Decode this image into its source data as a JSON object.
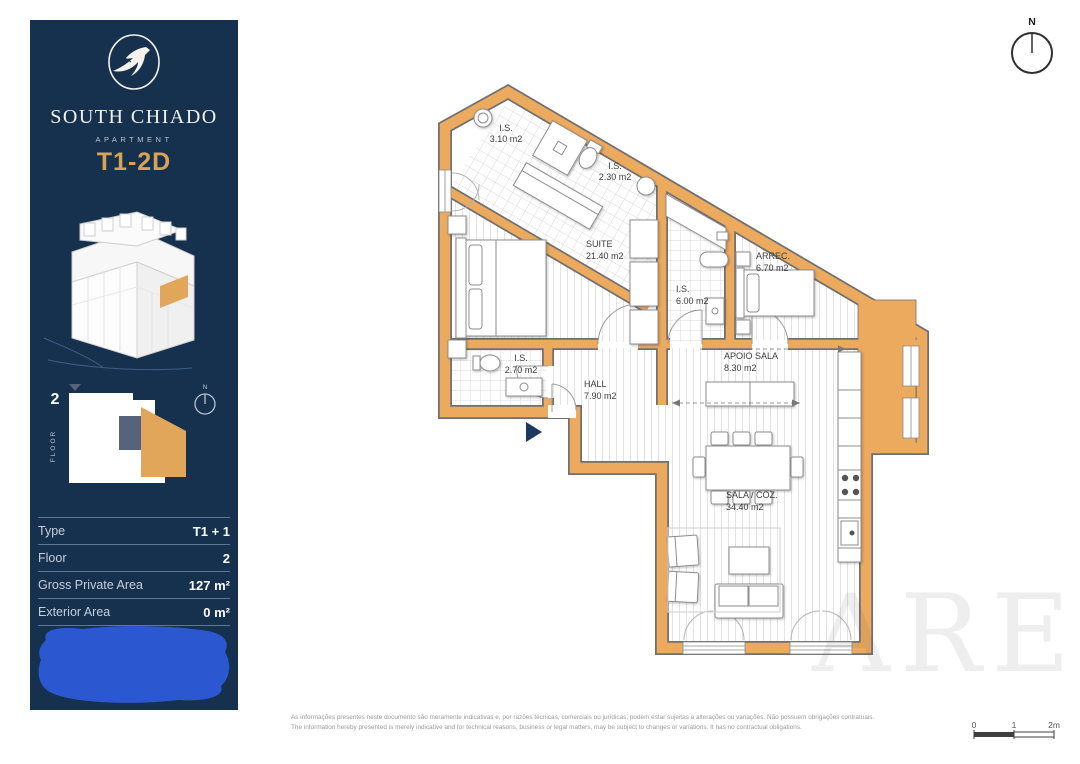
{
  "sidebar": {
    "brand": "SOUTH CHIADO",
    "subtitle": "APARTMENT",
    "unit_label": "T1-2D",
    "floor_key": {
      "floor_number": "2",
      "floor_label": "FLOOR",
      "north_label": "N"
    },
    "spec_table": {
      "rows": [
        {
          "label": "Type",
          "value": "T1 + 1"
        },
        {
          "label": "Floor",
          "value": "2"
        },
        {
          "label": "Gross Private Area",
          "value": "127 m²"
        },
        {
          "label": "Exterior Area",
          "value": "0 m²"
        }
      ]
    }
  },
  "plan": {
    "north_label": "N",
    "rooms": [
      {
        "name": "I.S.",
        "area": "3.10 m2"
      },
      {
        "name": "I.S.",
        "area": "2.30 m2"
      },
      {
        "name": "SUITE",
        "area": "21.40 m2"
      },
      {
        "name": "I.S.",
        "area": "6.00 m2"
      },
      {
        "name": "ARREC.",
        "area": "6.70 m2"
      },
      {
        "name": "I.S.",
        "area": "2.70 m2"
      },
      {
        "name": "HALL",
        "area": "7.90 m2"
      },
      {
        "name": "APOIO SALA",
        "area": "8.30 m2"
      },
      {
        "name": "SALA / COZ.",
        "area": "34.40 m2"
      }
    ]
  },
  "footer": {
    "disclaimer_pt": "As informações presentes neste documento são meramente indicativas e, por razões técnicas, comerciais ou jurídicas, podem estar sujeitas a alterações ou variações. Não possuem obrigações contratuais.",
    "disclaimer_en": "The information hereby presented is merely indicative and for technical reasons, business or legal matters, may be subject to changes or variations. It has no contractual obligations.",
    "scale_labels": {
      "zero": "0",
      "one": "1",
      "two": "2m"
    }
  },
  "watermark": "ARE",
  "colors": {
    "sidebar_navy": "#16314e",
    "accent_gold": "#d8a355",
    "wall_orange": "#ecaa5e",
    "redaction_blue": "#2b58d0"
  }
}
